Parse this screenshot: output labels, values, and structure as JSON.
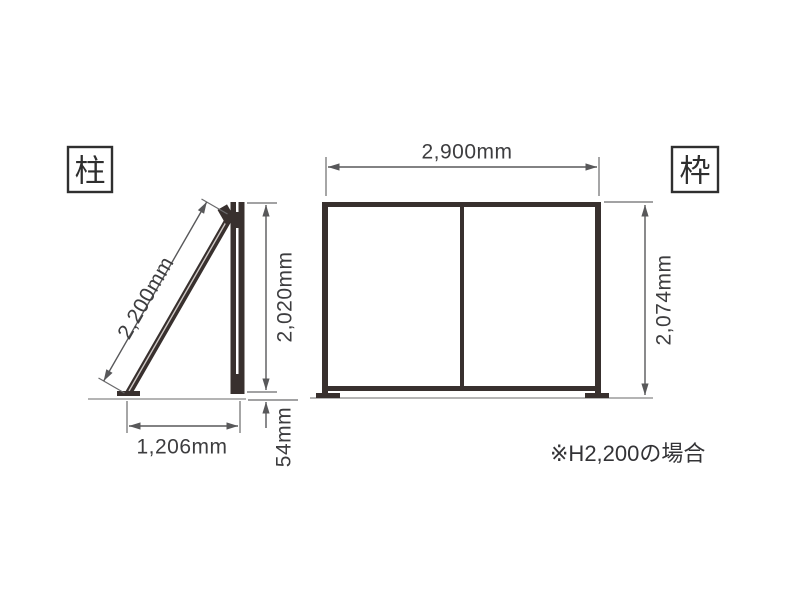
{
  "pillar": {
    "label": "柱",
    "brace_length": "2,200mm",
    "post_height": "2,020mm",
    "base_width": "1,206mm",
    "ground_clearance": "54mm"
  },
  "frame": {
    "label": "枠",
    "width": "2,900mm",
    "height": "2,074mm"
  },
  "note": "※H2,200の場合",
  "colors": {
    "structure": "#38302e",
    "dimension_line": "#58585a",
    "text": "#3d3d3f",
    "ground_line": "#9b9b9b",
    "background": "#ffffff"
  }
}
